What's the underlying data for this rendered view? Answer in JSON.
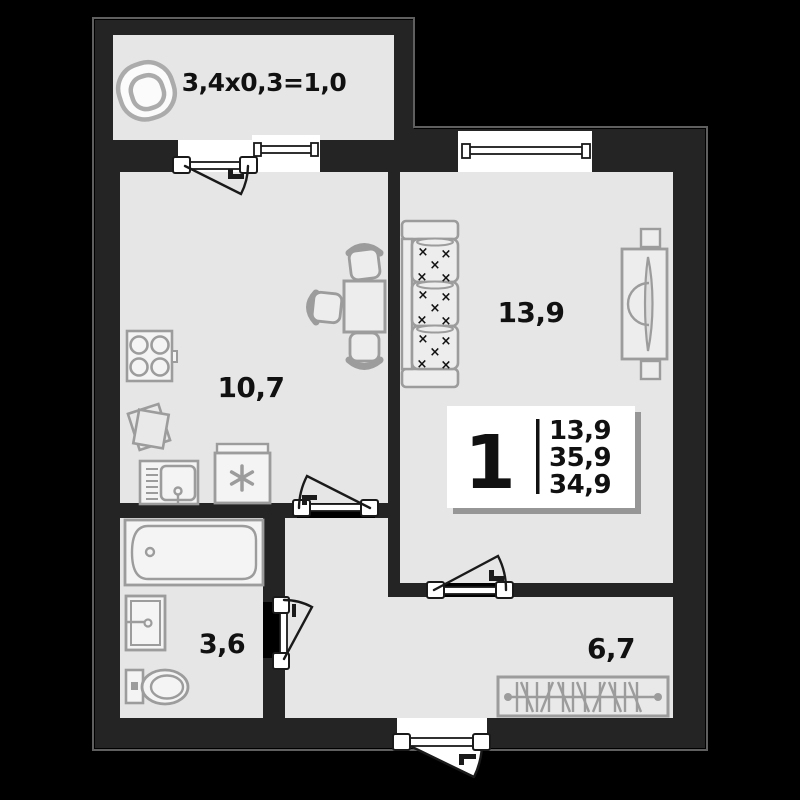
{
  "plan_title": "1-room apartment floor plan",
  "colors": {
    "background": "#000000",
    "wall": "#242424",
    "wall_edge": "#5f5f5f",
    "floor": "#e6e6e6",
    "fixture_stroke": "#9c9c9c",
    "opening_white": "#ffffff",
    "label_text": "#111111"
  },
  "rooms": {
    "balcony": {
      "label": "3,4x0,3=1,0"
    },
    "kitchen": {
      "area": "10,7"
    },
    "bedroom": {
      "area": "13,9"
    },
    "bathroom": {
      "area": "3,6"
    },
    "hallway": {
      "area": "6,7"
    }
  },
  "badge": {
    "room_count": "1",
    "values": [
      "13,9",
      "35,9",
      "34,9"
    ]
  },
  "icons": {
    "sofa_mark": "×"
  }
}
